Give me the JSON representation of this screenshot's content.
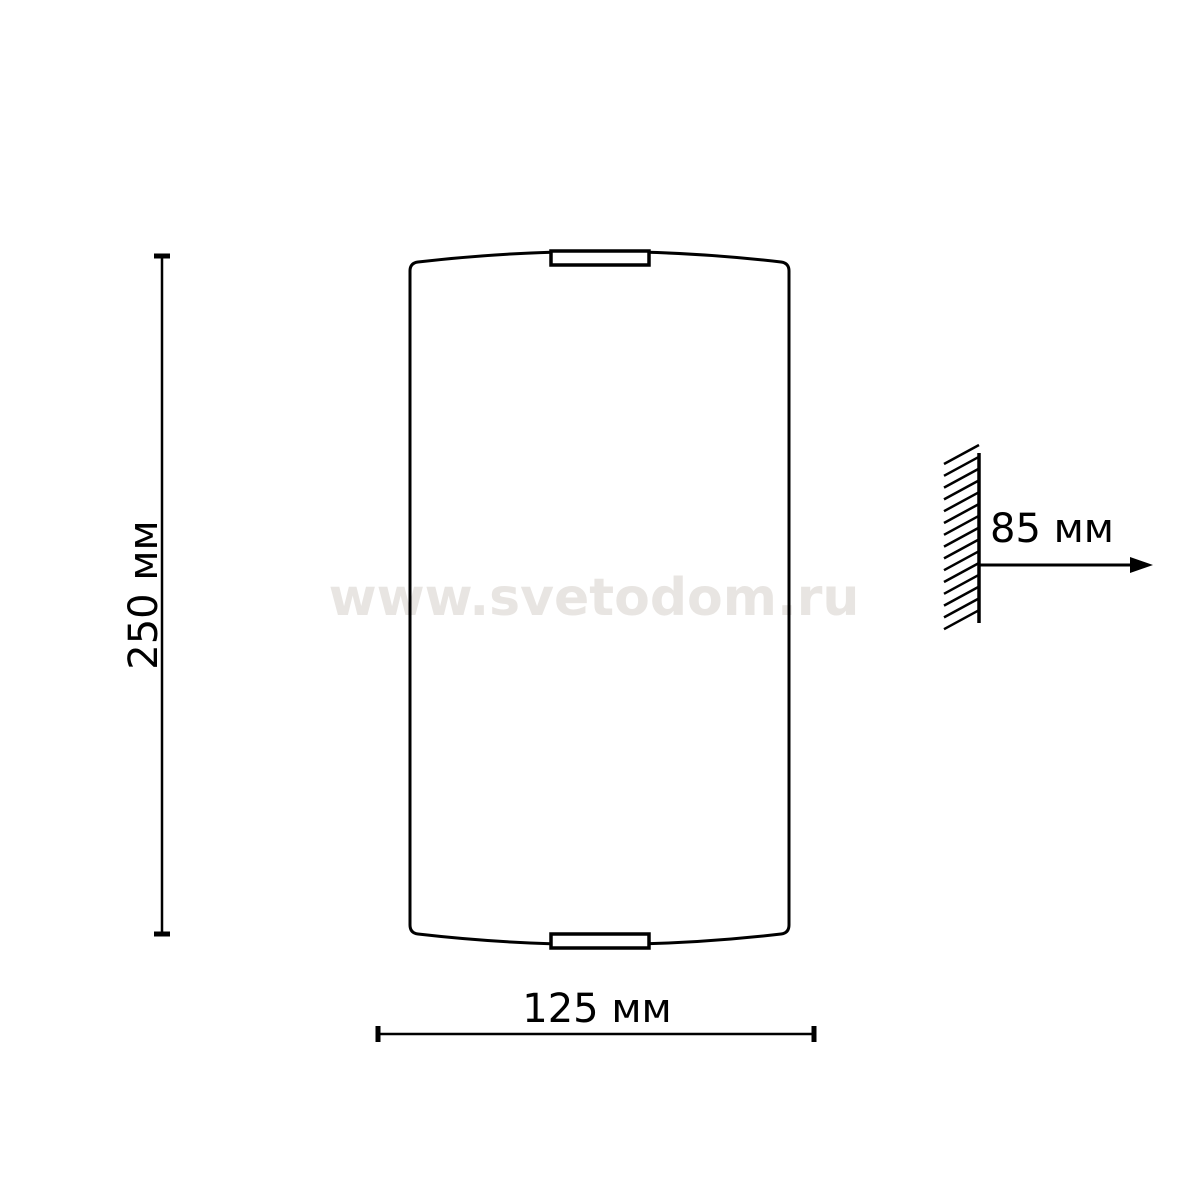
{
  "page": {
    "background_color": "#ffffff"
  },
  "watermark": {
    "text": "www.svetodom.ru",
    "color": "#e8e5e2"
  },
  "drawing": {
    "line_color": "#000000",
    "dimensions": {
      "height": {
        "label": "250 мм",
        "value": "250",
        "unit": "мм",
        "orientation": "vertical"
      },
      "width": {
        "label": "125 мм",
        "value": "125",
        "unit": "мм",
        "orientation": "horizontal"
      },
      "wall_distance": {
        "label": "85 мм",
        "value": "85",
        "unit": "мм",
        "orientation": "horizontal"
      }
    }
  }
}
